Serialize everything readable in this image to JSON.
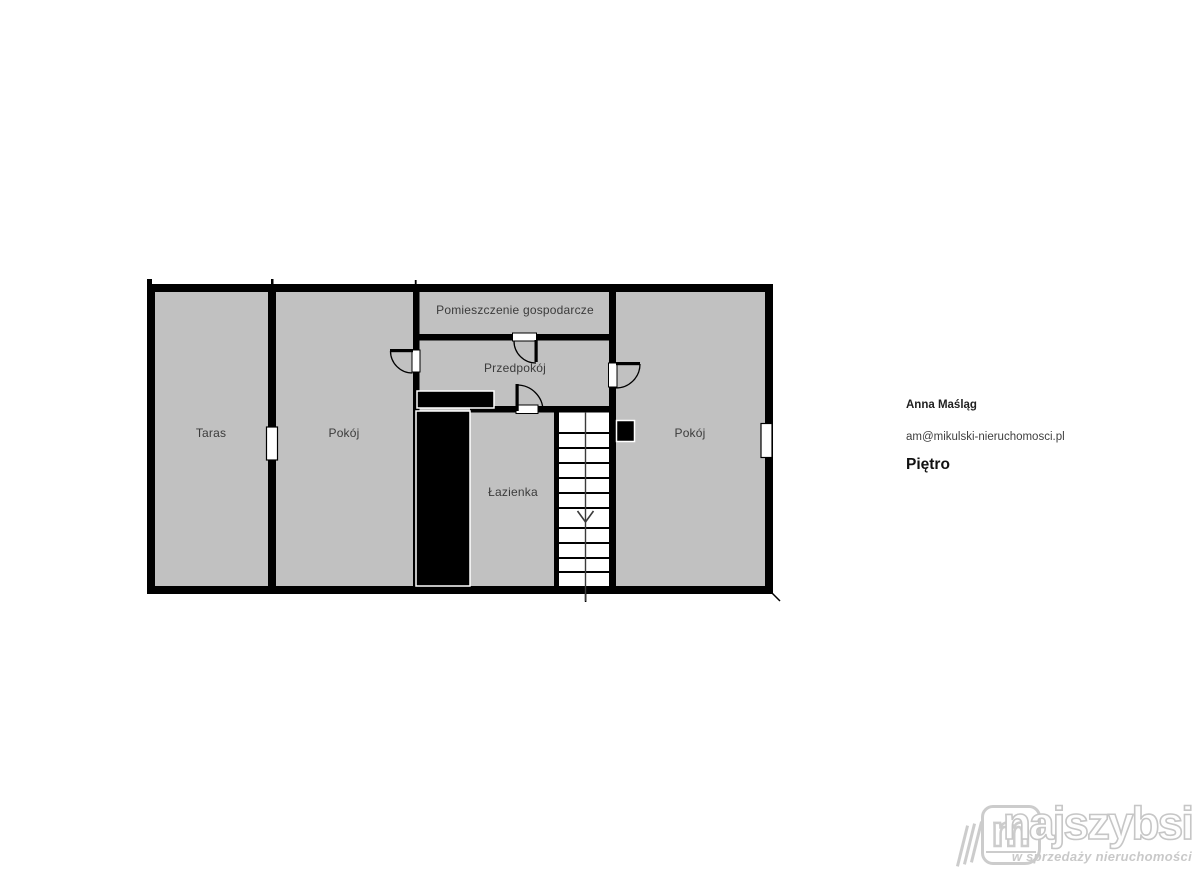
{
  "floorplan": {
    "rooms": {
      "taras": "Taras",
      "pokoj_left": "Pokój",
      "pomieszczenie_gospodarcze": "Pomieszczenie gospodarcze",
      "przedpokoj": "Przedpokój",
      "lazienka": "Łazienka",
      "pokoj_right": "Pokój"
    }
  },
  "contact": {
    "name": "Anna Maśląg",
    "email": "am@mikulski-nieruchomosci.pl",
    "floor_label": "Piętro"
  },
  "logo": {
    "brand": "najszybsi",
    "tagline": "w sprzedaży nieruchomości",
    "monogram": "m"
  },
  "colors": {
    "floor_fill": "#c1c1c1",
    "wall": "#000000",
    "stairs_fill": "#ffffff",
    "label_text": "#3b3b3b",
    "logo_gray": "#c9c9c9"
  }
}
